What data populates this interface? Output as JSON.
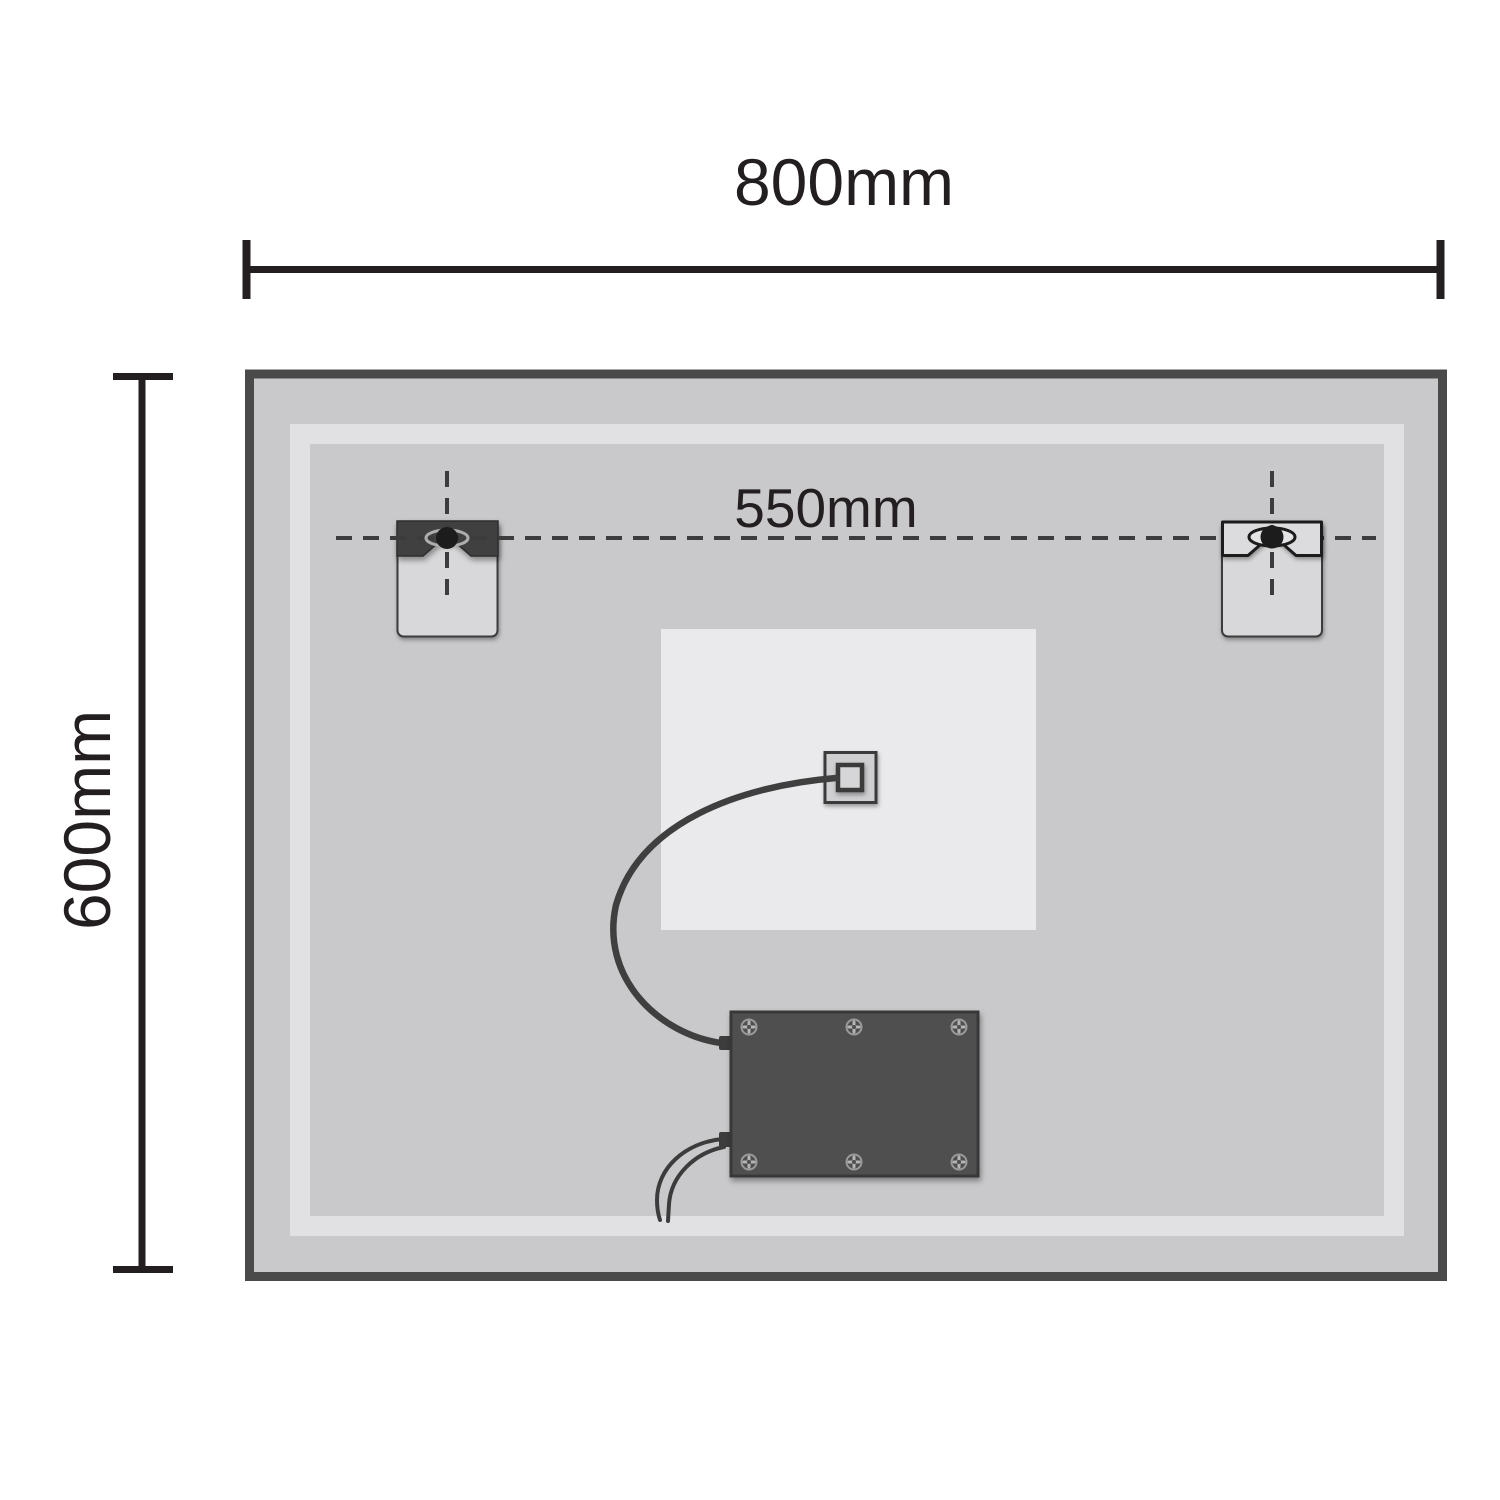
{
  "diagram": {
    "type": "product-dimension-diagram",
    "subject": "led-mirror-back-panel"
  },
  "dimensions": {
    "width_label": "800mm",
    "height_label": "600mm",
    "bracket_spacing_label": "550mm"
  },
  "colors": {
    "page_background": "#ffffff",
    "frame_stroke": "#4a4a4a",
    "mirror_fill": "#c9c9cb",
    "led_band": "#e1e1e3",
    "backing_plate": "#eaeaec",
    "bracket_plate": "#d8d8da",
    "bracket_bar_dark": "#3f3f3f",
    "keyhole_dark": "#1c1c1c",
    "driver_box_fill": "#4f4f4f",
    "dash_color": "#3c3c3c",
    "dimension_line_color": "#231f20"
  }
}
